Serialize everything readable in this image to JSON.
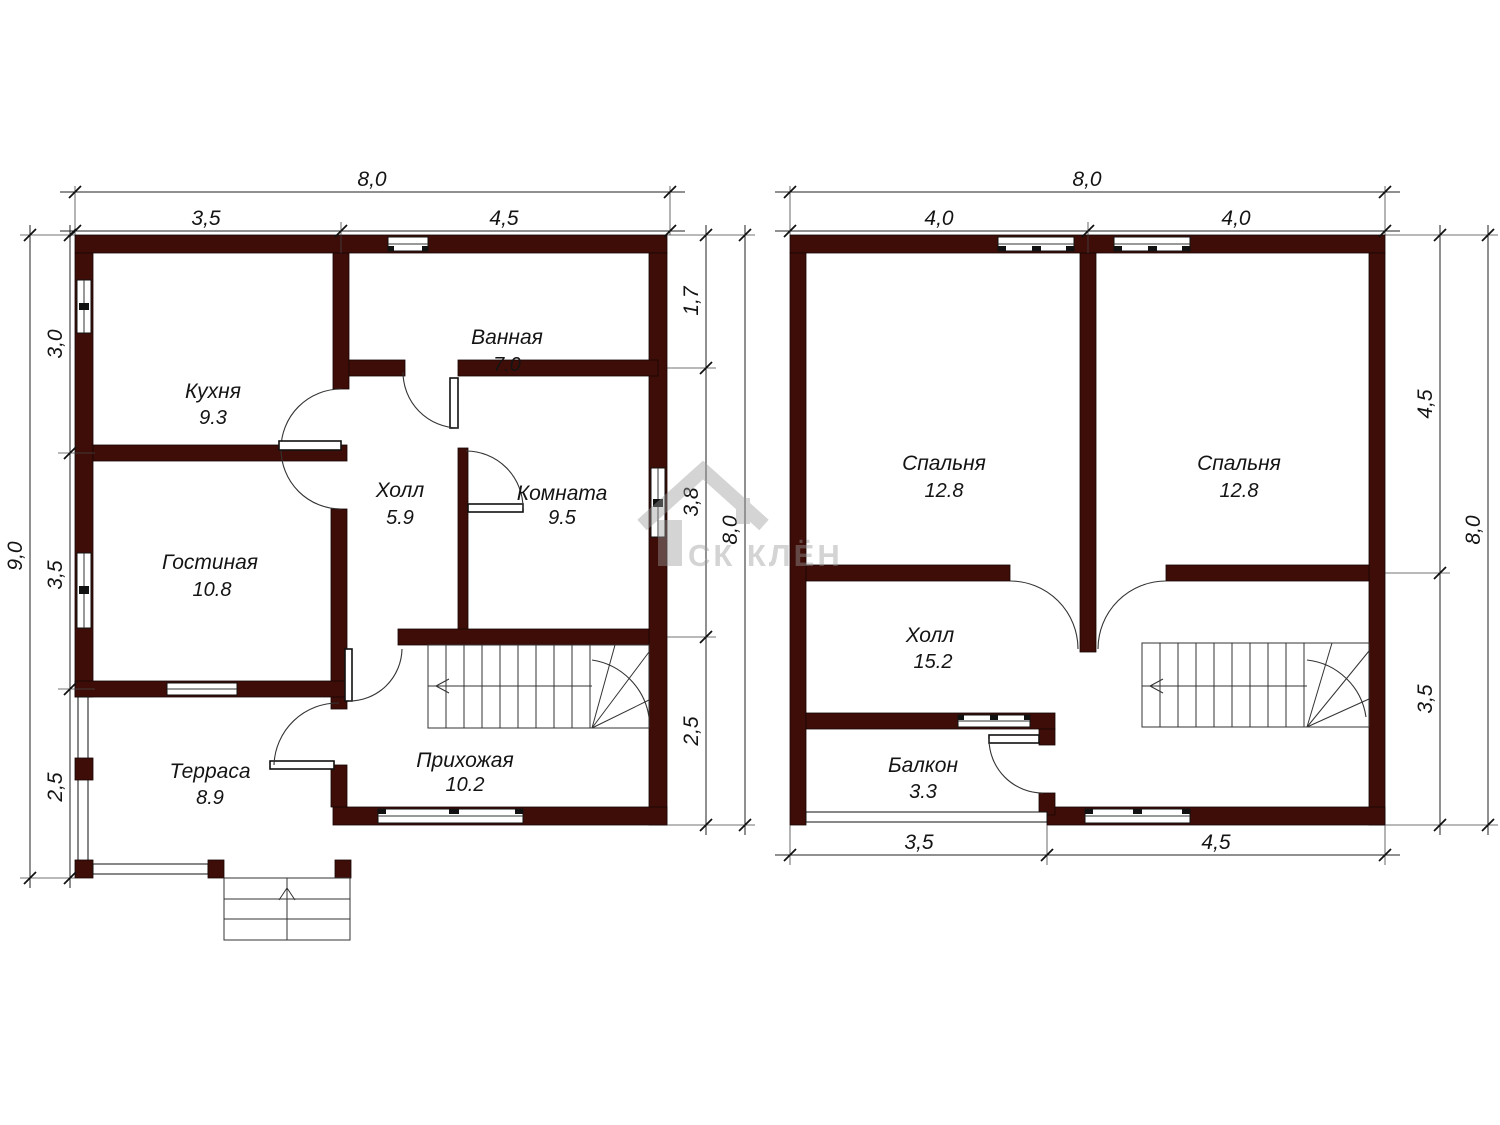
{
  "watermark": {
    "brand": "СК КЛЁН"
  },
  "floor1": {
    "rooms": [
      {
        "name": "Кухня",
        "area": "9.3"
      },
      {
        "name": "Ванная",
        "area": "7.0"
      },
      {
        "name": "Холл",
        "area": "5.9"
      },
      {
        "name": "Комната",
        "area": "9.5"
      },
      {
        "name": "Гостиная",
        "area": "10.8"
      },
      {
        "name": "Терраса",
        "area": "8.9"
      },
      {
        "name": "Прихожая",
        "area": "10.2"
      }
    ],
    "dims": {
      "top_total": "8,0",
      "top": [
        "3,5",
        "4,5"
      ],
      "left_total": "9,0",
      "left": [
        "3,0",
        "3,5",
        "2,5"
      ],
      "right_total": "8,0",
      "right": [
        "1,7",
        "3,8",
        "2,5"
      ]
    }
  },
  "floor2": {
    "rooms": [
      {
        "name": "Спальня",
        "area": "12.8"
      },
      {
        "name": "Спальня",
        "area": "12.8"
      },
      {
        "name": "Холл",
        "area": "15.2"
      },
      {
        "name": "Балкон",
        "area": "3.3"
      }
    ],
    "dims": {
      "top_total": "8,0",
      "top": [
        "4,0",
        "4,0"
      ],
      "right_total": "8,0",
      "right": [
        "4,5",
        "3,5"
      ],
      "bottom": [
        "3,5",
        "4,5"
      ]
    }
  }
}
